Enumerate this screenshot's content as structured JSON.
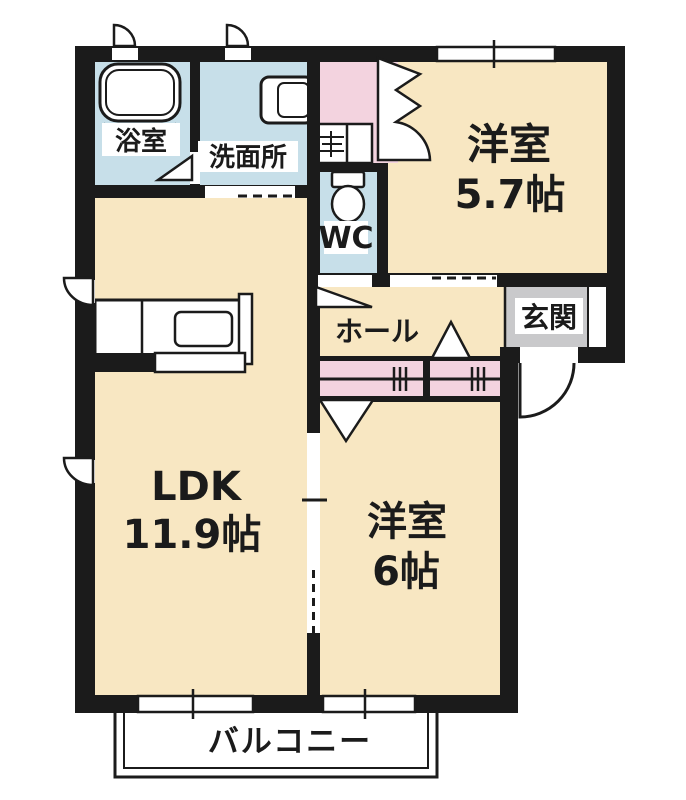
{
  "floorplan": {
    "title": "apartment-floor-plan-1LDK",
    "rooms": {
      "bath": {
        "label": "浴室"
      },
      "washroom": {
        "label": "洗面所"
      },
      "wc": {
        "label": "WC"
      },
      "bedroom1": {
        "label": "洋室",
        "size": "5.7帖"
      },
      "hall": {
        "label": "ホール"
      },
      "entrance": {
        "label": "玄関"
      },
      "ldk": {
        "label": "LDK",
        "size": "11.9帖"
      },
      "bedroom2": {
        "label": "洋室",
        "size": "6帖"
      },
      "balcony": {
        "label": "バルコニー"
      }
    },
    "colors": {
      "room_cream": "#F8E7C2",
      "wet_blue": "#C7DFE9",
      "closet_pink": "#F3D3DF",
      "entrance_gray": "#C9C9CB",
      "wall_black": "#1B1B1B",
      "line_white": "#FFFFFF"
    }
  }
}
